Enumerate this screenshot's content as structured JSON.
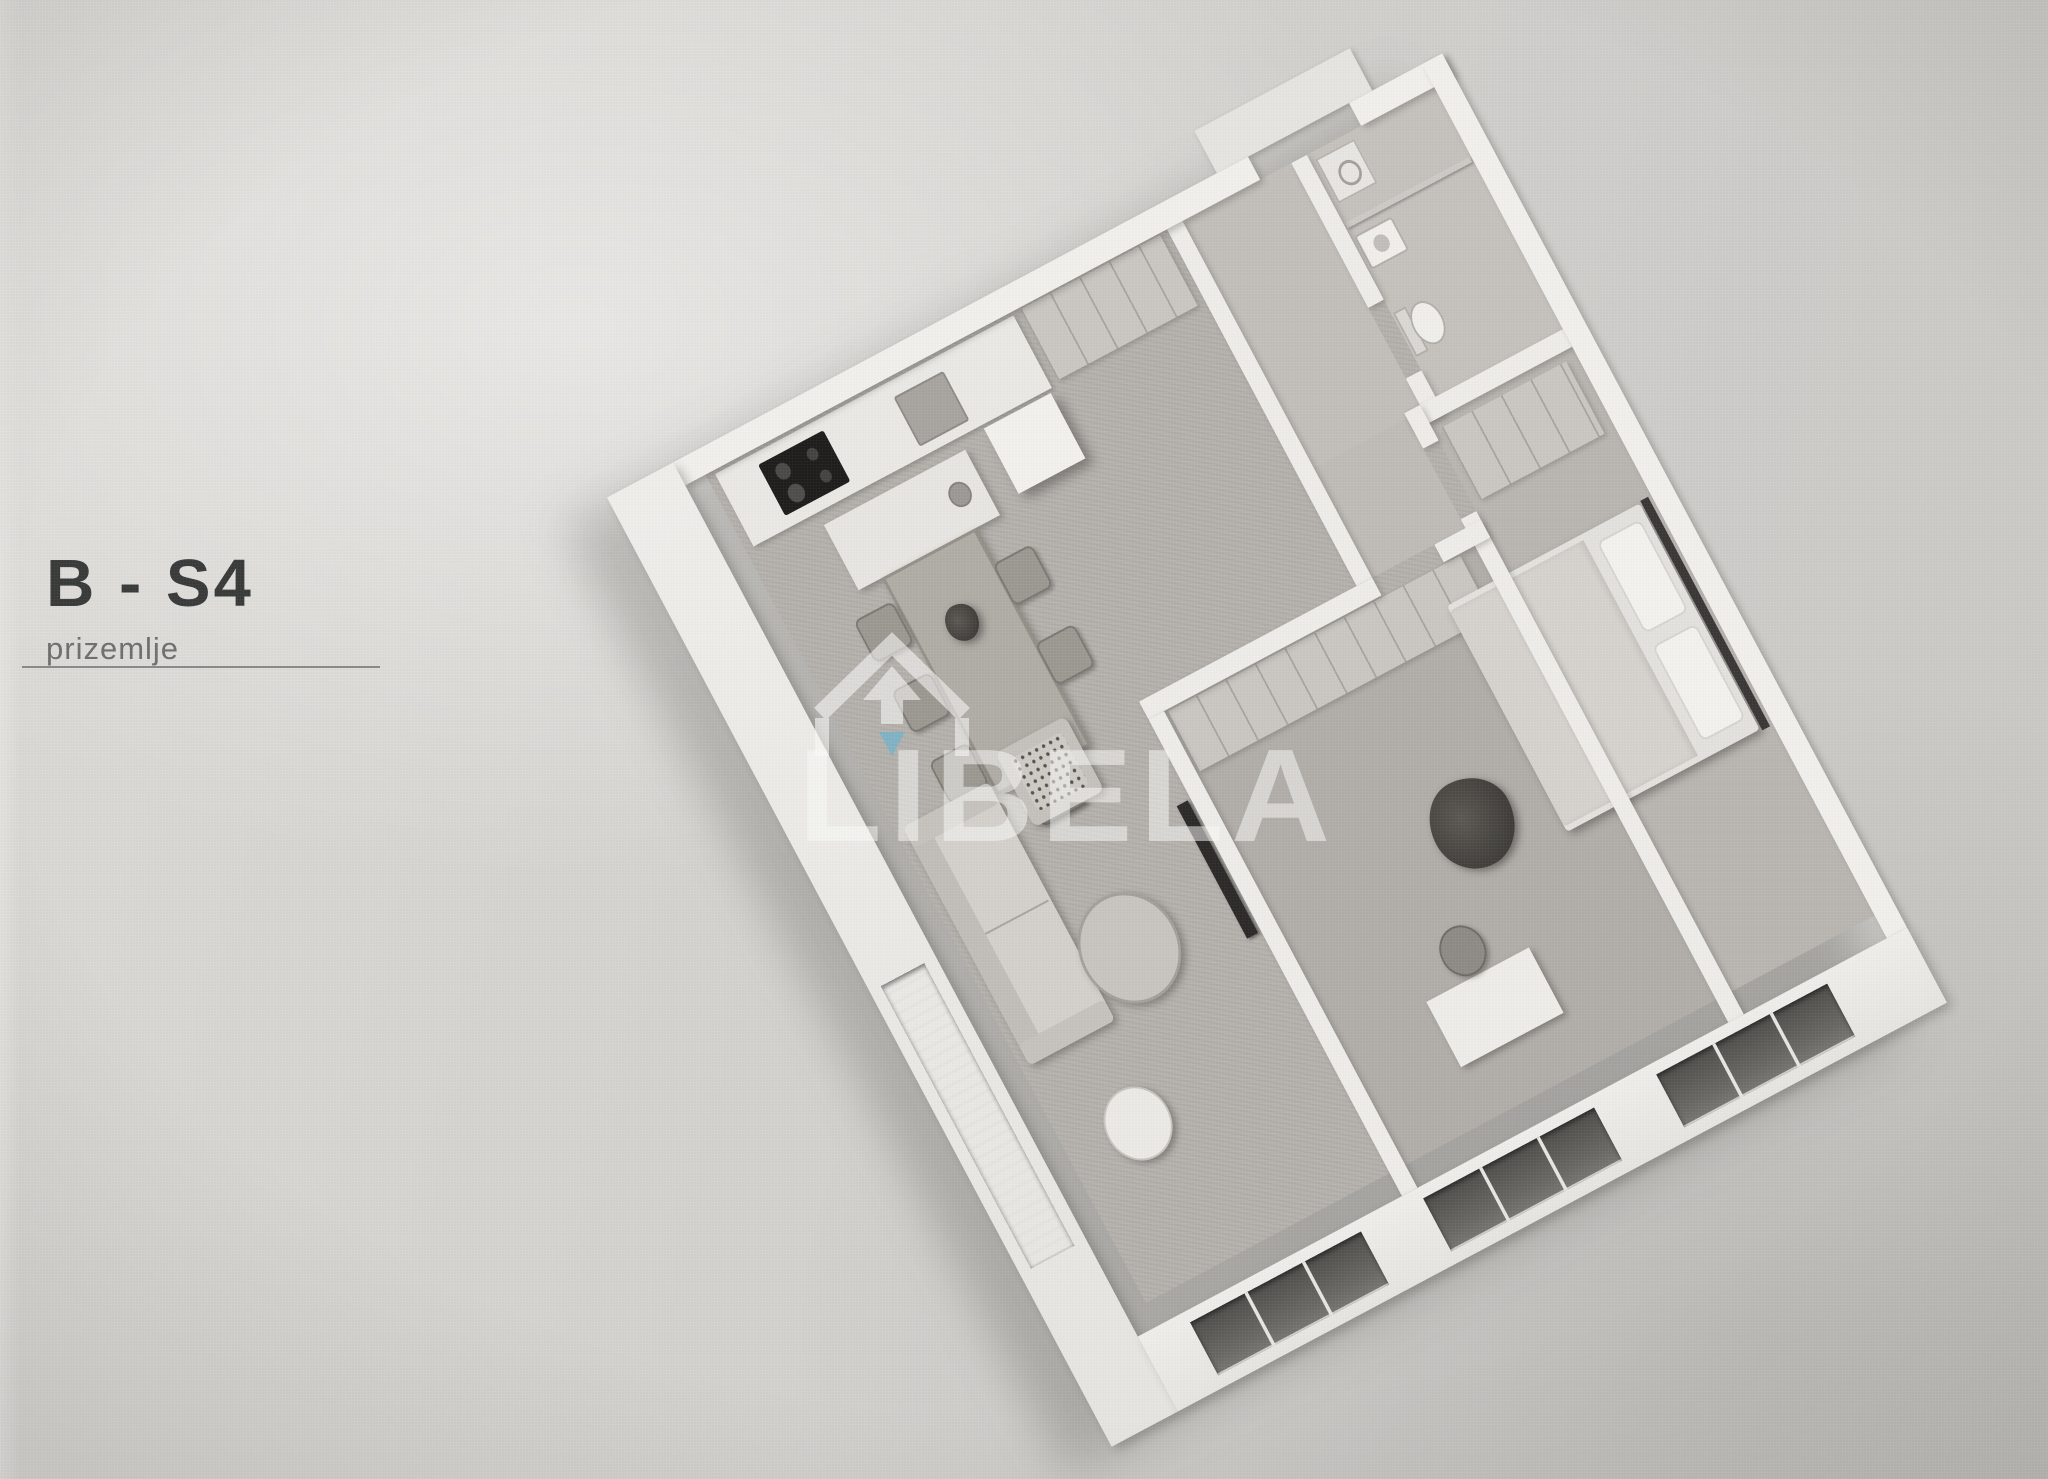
{
  "page": {
    "background_color": "#d4d2ce",
    "kind": "scanned real-estate floor plan page"
  },
  "plan_label": {
    "title": "B - S4",
    "subtitle": "prizemlje"
  },
  "watermark": {
    "text": "LIBELA",
    "accent_color": "#5fb6d9",
    "logo_icon": "libela-house-arrow-logo"
  },
  "floorplan": {
    "type": "3d-isometric-apartment",
    "rooms": [
      "kitchen",
      "dining area",
      "living room",
      "entry hall",
      "bathroom",
      "middle room",
      "bedroom"
    ],
    "window_glass_color": "#55534f",
    "wall_color": "#f2f1ee",
    "floor_color": "#b6b3ae"
  }
}
